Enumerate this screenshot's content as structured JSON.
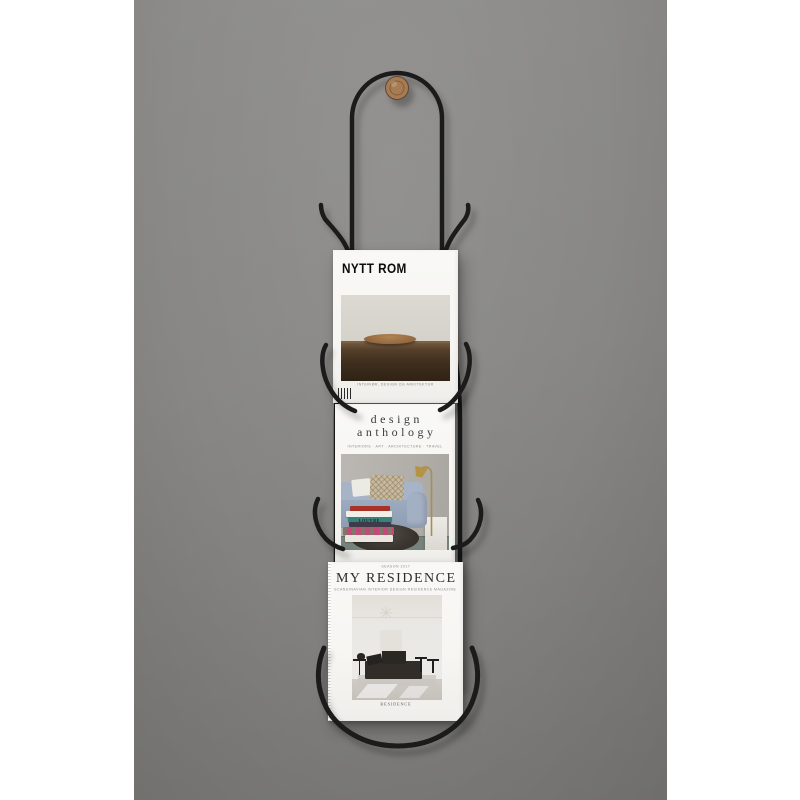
{
  "meta": {
    "alt": "Black wire wall-mounted magazine rack hanging from a wooden knob on a grey wall, holding three interior design magazines"
  },
  "colors": {
    "wall_top": "#8d8c8a",
    "wall_bottom": "#7b7a78",
    "wire": "#1b1b1b",
    "knob": "#a87c52",
    "paper": "#f7f6f3"
  },
  "magazines": {
    "nytt_rom": {
      "title": "NYTT ROM",
      "tagline": "INTERIØR, DESIGN OG ARKITEKTUR"
    },
    "design_anthology": {
      "title_line1": "design",
      "title_line2": "anthology",
      "categories": "INTERIORS · ART · ARCHITECTURE · TRAVEL",
      "book_spine": "LOUVRE",
      "book_colors": [
        "#a83226",
        "#f2efe9",
        "#37837a",
        "#413a4a",
        "#c2497a",
        "#eae6dd"
      ]
    },
    "my_residence": {
      "eyebrow": "SEASON 2017",
      "title": "MY RESIDENCE",
      "subtitle": "SCANDINAVIAN INTERIOR DESIGN RESIDENCE MAGAZINE",
      "brand": "RESIDENCE"
    }
  }
}
